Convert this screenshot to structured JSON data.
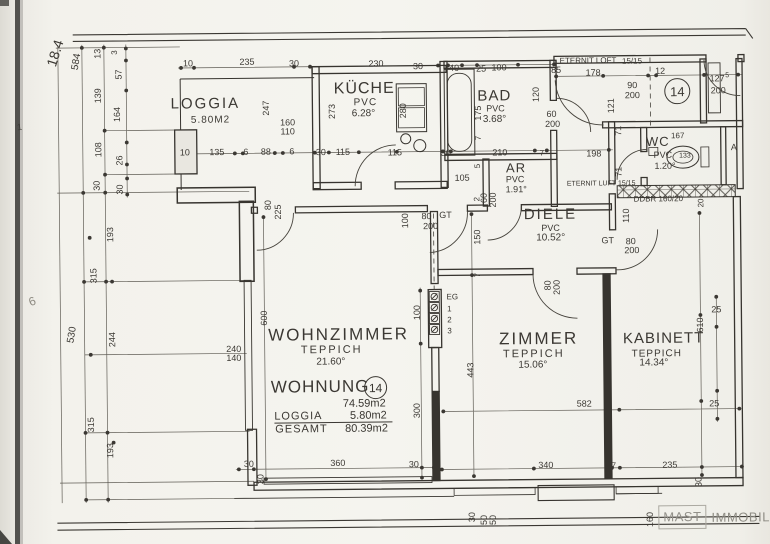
{
  "unit_badge": {
    "top": "14",
    "summary": "14"
  },
  "logo": {
    "box": "MAST",
    "name": "IMMOBILIEN"
  },
  "rooms": [
    {
      "name": "LOGGIA",
      "area": "5.80M2"
    },
    {
      "name": "KÜCHE",
      "floor": "PVC",
      "area": "6.28"
    },
    {
      "name": "BAD",
      "floor": "PVC",
      "area": "3.68"
    },
    {
      "name": "AR",
      "floor": "PVC",
      "area": "1.91"
    },
    {
      "name": "WC",
      "floor": "PVC",
      "area": "1.20"
    },
    {
      "name": "DIELE",
      "floor": "PVC",
      "area": "10.52"
    },
    {
      "name": "WOHNZIMMER",
      "floor": "TEPPICH",
      "area": "21.60"
    },
    {
      "name": "ZIMMER",
      "floor": "TEPPICH",
      "area": "15.06"
    },
    {
      "name": "KABINETT",
      "floor": "TEPPICH",
      "area": "14.34"
    }
  ],
  "summary": {
    "title": "WOHNUNG",
    "number": "14",
    "wohnung_area": "74.59m2",
    "loggia_label": "LOGGIA",
    "loggia_area": "5.80m2",
    "gesamt_label": "GESAMT",
    "gesamt_area": "80.39m2"
  },
  "labels": [
    {
      "n": "room-label-loggia",
      "t": "LOGGIA",
      "x": 207,
      "y": 102,
      "s": 15,
      "ls": 2
    },
    {
      "n": "area-loggia",
      "t": "5.80M2",
      "x": 212,
      "y": 119,
      "s": 10,
      "ls": 1
    },
    {
      "n": "room-label-kueche",
      "t": "KÜCHE",
      "x": 366,
      "y": 89,
      "s": 16,
      "ls": 1
    },
    {
      "t": "PVC",
      "x": 367,
      "y": 103,
      "s": 10,
      "ls": 1
    },
    {
      "t": "6.28°",
      "x": 365,
      "y": 114,
      "s": 10
    },
    {
      "n": "room-label-bad",
      "t": "BAD",
      "x": 496,
      "y": 97,
      "s": 15,
      "ls": 1
    },
    {
      "t": "PVC",
      "x": 497,
      "y": 110,
      "s": 9
    },
    {
      "t": "3.68°",
      "x": 496,
      "y": 121,
      "s": 10
    },
    {
      "n": "room-label-ar",
      "t": "AR",
      "x": 517,
      "y": 169,
      "s": 13,
      "ls": 1
    },
    {
      "t": "PVC",
      "x": 516,
      "y": 181,
      "s": 9
    },
    {
      "t": "1.91°",
      "x": 517,
      "y": 191,
      "s": 9
    },
    {
      "n": "room-label-wc",
      "t": "WC",
      "x": 659,
      "y": 144,
      "s": 13,
      "ls": 1
    },
    {
      "t": "167",
      "x": 679,
      "y": 139,
      "s": 8
    },
    {
      "t": "PVC",
      "x": 664,
      "y": 158,
      "s": 9
    },
    {
      "t": "1.20°",
      "x": 666,
      "y": 169,
      "s": 9
    },
    {
      "t": "133",
      "x": 686,
      "y": 159,
      "s": 7
    },
    {
      "n": "room-label-diele",
      "t": "DIELE",
      "x": 551,
      "y": 216,
      "s": 15,
      "ls": 2
    },
    {
      "t": "PVC",
      "x": 551,
      "y": 230,
      "s": 9
    },
    {
      "t": "10.52°",
      "x": 551,
      "y": 240,
      "s": 10
    },
    {
      "n": "room-label-wohnzimmer",
      "t": "WOHNZIMMER",
      "x": 338,
      "y": 334,
      "s": 17,
      "ls": 2
    },
    {
      "t": "TEPPICH",
      "x": 331,
      "y": 350,
      "s": 11,
      "ls": 2
    },
    {
      "t": "21.60°",
      "x": 330,
      "y": 362,
      "s": 10
    },
    {
      "n": "room-label-zimmer",
      "t": "ZIMMER",
      "x": 538,
      "y": 340,
      "s": 17,
      "ls": 2
    },
    {
      "t": "TEPPICH",
      "x": 533,
      "y": 356,
      "s": 11,
      "ls": 2
    },
    {
      "t": "15.06°",
      "x": 532,
      "y": 367,
      "s": 10
    },
    {
      "n": "room-label-kabinett",
      "t": "KABINETT",
      "x": 663,
      "y": 341,
      "s": 15,
      "ls": 1
    },
    {
      "t": "TEPPICH",
      "x": 656,
      "y": 357,
      "s": 10,
      "ls": 1
    },
    {
      "t": "14.34°",
      "x": 653,
      "y": 366,
      "s": 10
    },
    {
      "n": "summary-title",
      "t": "WOHNUNG",
      "x": 319,
      "y": 386,
      "s": 17,
      "ls": 1
    },
    {
      "n": "summary-wohnung-area",
      "t": "74.59m2",
      "x": 363,
      "y": 404,
      "s": 11
    },
    {
      "t": "LOGGIA",
      "x": 297,
      "y": 416,
      "s": 11,
      "ls": 1
    },
    {
      "t": "5.80m2",
      "x": 367,
      "y": 416,
      "s": 11
    },
    {
      "t": "GESAMT",
      "x": 300,
      "y": 429,
      "s": 11,
      "ls": 1
    },
    {
      "t": "80.39m2",
      "x": 365,
      "y": 429,
      "s": 11
    },
    {
      "t": "ETERNIT LOFT",
      "x": 590,
      "y": 63,
      "s": 8
    },
    {
      "t": "15/15",
      "x": 634,
      "y": 64,
      "s": 8
    },
    {
      "t": "ETERNIT LUFT 15/15",
      "x": 602,
      "y": 186,
      "s": 7
    },
    {
      "t": "DDBR 160/20",
      "x": 659,
      "y": 202,
      "s": 8
    },
    {
      "t": "EG",
      "x": 452,
      "y": 298,
      "s": 8
    },
    {
      "t": "1",
      "x": 449,
      "y": 310,
      "s": 8
    },
    {
      "t": "2",
      "x": 449,
      "y": 321,
      "s": 8
    },
    {
      "t": "3",
      "x": 449,
      "y": 332,
      "s": 8
    },
    {
      "t": "80",
      "x": 427,
      "y": 217,
      "s": 9
    },
    {
      "t": "GT",
      "x": 446,
      "y": 216,
      "s": 9
    },
    {
      "t": "200",
      "x": 431,
      "y": 227,
      "s": 9
    },
    {
      "t": "GT",
      "x": 608,
      "y": 243,
      "s": 9
    },
    {
      "t": "80",
      "x": 631,
      "y": 244,
      "s": 9
    },
    {
      "t": "200",
      "x": 632,
      "y": 253,
      "s": 9
    },
    {
      "t": "A",
      "x": 735,
      "y": 151,
      "s": 9
    },
    {
      "t": "6",
      "x": 32,
      "y": 298,
      "s": 12,
      "r": -20,
      "col": "#8d8a81"
    },
    {
      "t": "1",
      "x": 21,
      "y": 124,
      "s": 9,
      "r": -8,
      "col": "#75726a"
    },
    {
      "t": "10",
      "x": 190,
      "y": 62
    },
    {
      "t": "235",
      "x": 249,
      "y": 61
    },
    {
      "t": "30",
      "x": 296,
      "y": 63
    },
    {
      "t": "230",
      "x": 378,
      "y": 64
    },
    {
      "t": "30",
      "x": 420,
      "y": 67
    },
    {
      "t": "40",
      "x": 456,
      "y": 69
    },
    {
      "t": "25",
      "x": 483,
      "y": 70
    },
    {
      "t": "100",
      "x": 501,
      "y": 69
    },
    {
      "t": "85",
      "x": 558,
      "y": 72
    },
    {
      "t": "178",
      "x": 595,
      "y": 75
    },
    {
      "t": "12",
      "x": 662,
      "y": 74
    },
    {
      "t": "90",
      "x": 634,
      "y": 88
    },
    {
      "t": "200",
      "x": 634,
      "y": 98
    },
    {
      "t": "127",
      "x": 719,
      "y": 82
    },
    {
      "t": "5",
      "x": 729,
      "y": 79,
      "s": 7
    },
    {
      "t": "200",
      "x": 720,
      "y": 94
    },
    {
      "t": "247",
      "x": 268,
      "y": 107,
      "r": -90
    },
    {
      "t": "273",
      "x": 334,
      "y": 111,
      "r": -90
    },
    {
      "t": "280",
      "x": 405,
      "y": 111,
      "r": -90
    },
    {
      "t": "120",
      "x": 538,
      "y": 96,
      "r": -90
    },
    {
      "t": "175",
      "x": 480,
      "y": 114,
      "r": -90
    },
    {
      "t": "7",
      "x": 480,
      "y": 139,
      "r": -90,
      "s": 8
    },
    {
      "t": "121",
      "x": 613,
      "y": 108,
      "r": -90
    },
    {
      "t": "71",
      "x": 620,
      "y": 133,
      "r": -90
    },
    {
      "t": "71",
      "x": 620,
      "y": 174,
      "r": -90
    },
    {
      "t": "160",
      "x": 289,
      "y": 122
    },
    {
      "t": "110",
      "x": 289,
      "y": 131
    },
    {
      "t": "60",
      "x": 553,
      "y": 116
    },
    {
      "t": "200",
      "x": 554,
      "y": 126
    },
    {
      "t": "10",
      "x": 186,
      "y": 151
    },
    {
      "t": "135",
      "x": 218,
      "y": 151
    },
    {
      "t": "6",
      "x": 247,
      "y": 151
    },
    {
      "t": "88",
      "x": 267,
      "y": 151
    },
    {
      "t": "6",
      "x": 293,
      "y": 151
    },
    {
      "t": "30",
      "x": 322,
      "y": 152
    },
    {
      "t": "115",
      "x": 344,
      "y": 152
    },
    {
      "t": "115",
      "x": 396,
      "y": 153
    },
    {
      "t": "30",
      "x": 447,
      "y": 154
    },
    {
      "t": "210",
      "x": 501,
      "y": 154
    },
    {
      "t": "7",
      "x": 543,
      "y": 155,
      "s": 8
    },
    {
      "t": "198",
      "x": 595,
      "y": 156
    },
    {
      "t": "105",
      "x": 463,
      "y": 179
    },
    {
      "t": "5",
      "x": 479,
      "y": 167,
      "r": -90,
      "s": 8
    },
    {
      "t": "2",
      "x": 478,
      "y": 200,
      "r": -90,
      "s": 8
    },
    {
      "t": "60",
      "x": 485,
      "y": 199,
      "r": -90
    },
    {
      "t": "200",
      "x": 494,
      "y": 201,
      "r": -90
    },
    {
      "t": "150",
      "x": 478,
      "y": 238,
      "r": -90
    },
    {
      "t": "7",
      "x": 478,
      "y": 276,
      "r": -90,
      "s": 8
    },
    {
      "t": "100",
      "x": 406,
      "y": 221,
      "r": -90
    },
    {
      "t": "110",
      "x": 627,
      "y": 218,
      "r": -90
    },
    {
      "t": "20",
      "x": 702,
      "y": 206,
      "r": -90,
      "s": 8
    },
    {
      "t": "80",
      "x": 548,
      "y": 287,
      "r": -90
    },
    {
      "t": "200",
      "x": 557,
      "y": 289,
      "r": -90
    },
    {
      "t": "80",
      "x": 269,
      "y": 204,
      "r": -90
    },
    {
      "t": "225",
      "x": 279,
      "y": 211,
      "r": -90
    },
    {
      "t": "18.4",
      "x": 57,
      "y": 50,
      "r": -72,
      "s": 14
    },
    {
      "t": "584",
      "x": 79,
      "y": 59,
      "r": -80,
      "s": 10
    },
    {
      "t": "13",
      "x": 100,
      "y": 51,
      "r": -90
    },
    {
      "t": "3",
      "x": 117,
      "y": 50,
      "r": -90,
      "s": 8
    },
    {
      "t": "57",
      "x": 121,
      "y": 72,
      "r": -90
    },
    {
      "t": "139",
      "x": 100,
      "y": 93,
      "r": -90
    },
    {
      "t": "164",
      "x": 119,
      "y": 112,
      "r": -90
    },
    {
      "t": "108",
      "x": 100,
      "y": 147,
      "r": -90
    },
    {
      "t": "26",
      "x": 121,
      "y": 158,
      "r": -90
    },
    {
      "t": "30",
      "x": 98,
      "y": 183,
      "r": -90
    },
    {
      "t": "30",
      "x": 121,
      "y": 187,
      "r": -90
    },
    {
      "t": "193",
      "x": 111,
      "y": 232,
      "r": -90
    },
    {
      "t": "315",
      "x": 94,
      "y": 273,
      "r": -90
    },
    {
      "t": "530",
      "x": 72,
      "y": 332,
      "r": -80,
      "s": 10
    },
    {
      "t": "244",
      "x": 112,
      "y": 337,
      "r": -90
    },
    {
      "t": "315",
      "x": 90,
      "y": 422,
      "r": -90
    },
    {
      "t": "193",
      "x": 109,
      "y": 448,
      "r": -90
    },
    {
      "t": "600",
      "x": 264,
      "y": 317,
      "r": -90
    },
    {
      "t": "240",
      "x": 233,
      "y": 348
    },
    {
      "t": "140",
      "x": 233,
      "y": 357
    },
    {
      "t": "100",
      "x": 417,
      "y": 313,
      "r": -90
    },
    {
      "t": "300",
      "x": 416,
      "y": 411,
      "r": -90
    },
    {
      "t": "443",
      "x": 470,
      "y": 371,
      "r": -90
    },
    {
      "t": "610",
      "x": 700,
      "y": 328,
      "r": -90
    },
    {
      "t": "25",
      "x": 716,
      "y": 313
    },
    {
      "t": "25",
      "x": 713,
      "y": 407
    },
    {
      "t": "582",
      "x": 583,
      "y": 406
    },
    {
      "t": "30",
      "x": 247,
      "y": 463
    },
    {
      "t": "360",
      "x": 336,
      "y": 463
    },
    {
      "t": "30",
      "x": 412,
      "y": 465
    },
    {
      "t": "30",
      "x": 259,
      "y": 478,
      "r": -90
    },
    {
      "t": "340",
      "x": 544,
      "y": 467
    },
    {
      "t": "7",
      "x": 612,
      "y": 468,
      "s": 8
    },
    {
      "t": "235",
      "x": 668,
      "y": 468
    },
    {
      "t": "30",
      "x": 697,
      "y": 485,
      "r": -90
    },
    {
      "t": "30",
      "x": 470,
      "y": 518,
      "r": -90
    },
    {
      "t": "50",
      "x": 482,
      "y": 521,
      "r": -90
    },
    {
      "t": "50",
      "x": 491,
      "y": 521,
      "r": -90
    },
    {
      "t": "160",
      "x": 648,
      "y": 522,
      "r": -90
    }
  ]
}
